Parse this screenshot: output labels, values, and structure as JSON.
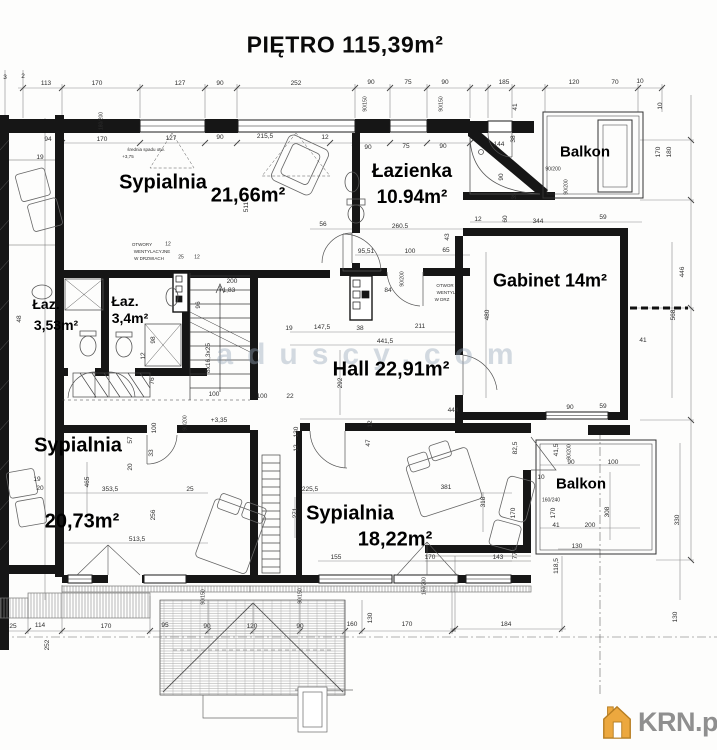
{
  "title": "PIĘTRO 115,39m²",
  "watermark": "aduscy.com",
  "logo": {
    "text": "KRN.pl",
    "house_fill": "#ECA83F",
    "house_stroke": "#B77E22",
    "text_color": "#8f8f8f"
  },
  "rooms": [
    {
      "name": "Sypialnia",
      "area": "21,66m²"
    },
    {
      "name": "Łazienka",
      "area": "10.94m²"
    },
    {
      "name": "Balkon",
      "area": ""
    },
    {
      "name": "Gabinet",
      "area": "14m²"
    },
    {
      "name": "Łaz.",
      "area": "3,53m²"
    },
    {
      "name": "Łaz.",
      "area": "3,4m²"
    },
    {
      "name": "Hall",
      "area": "22,91m²"
    },
    {
      "name": "Sypialnia",
      "area": "20,73m²"
    },
    {
      "name": "Sypialnia",
      "area": "18,22m²"
    },
    {
      "name": "Balkon",
      "area": ""
    }
  ],
  "room_labels": [
    {
      "t": "Sypialnia",
      "x": 163,
      "y": 183,
      "s": 20
    },
    {
      "t": "21,66m²",
      "x": 248,
      "y": 196,
      "s": 20
    },
    {
      "t": "Łazienka",
      "x": 412,
      "y": 172,
      "s": 19
    },
    {
      "t": "10.94m²",
      "x": 412,
      "y": 198,
      "s": 19
    },
    {
      "t": "Balkon",
      "x": 585,
      "y": 152,
      "s": 15
    },
    {
      "t": "Gabinet 14m²",
      "x": 550,
      "y": 281,
      "s": 18
    },
    {
      "t": "Łaz.",
      "x": 46,
      "y": 304,
      "s": 14
    },
    {
      "t": "3,53m²",
      "x": 56,
      "y": 325,
      "s": 14
    },
    {
      "t": "Łaz.",
      "x": 125,
      "y": 301,
      "s": 14
    },
    {
      "t": "3,4m²",
      "x": 130,
      "y": 318,
      "s": 14
    },
    {
      "t": "Hall 22,91m²",
      "x": 391,
      "y": 370,
      "s": 20
    },
    {
      "t": "Sypialnia",
      "x": 78,
      "y": 446,
      "s": 20
    },
    {
      "t": "20,73m²",
      "x": 82,
      "y": 522,
      "s": 20
    },
    {
      "t": "Sypialnia",
      "x": 350,
      "y": 514,
      "s": 20
    },
    {
      "t": "18,22m²",
      "x": 395,
      "y": 540,
      "s": 20
    },
    {
      "t": "Balkon",
      "x": 581,
      "y": 484,
      "s": 15
    }
  ],
  "dims": [
    {
      "t": "3",
      "x": 5,
      "y": 78
    },
    {
      "t": "2",
      "x": 23,
      "y": 77
    },
    {
      "t": "113",
      "x": 46,
      "y": 84
    },
    {
      "t": "170",
      "x": 97,
      "y": 84
    },
    {
      "t": "127",
      "x": 180,
      "y": 84
    },
    {
      "t": "90",
      "x": 220,
      "y": 84
    },
    {
      "t": "252",
      "x": 296,
      "y": 84
    },
    {
      "t": "90",
      "x": 371,
      "y": 83
    },
    {
      "t": "75",
      "x": 408,
      "y": 83
    },
    {
      "t": "90",
      "x": 445,
      "y": 83
    },
    {
      "t": "185",
      "x": 504,
      "y": 83
    },
    {
      "t": "120",
      "x": 574,
      "y": 83
    },
    {
      "t": "70",
      "x": 615,
      "y": 83
    },
    {
      "t": "10",
      "x": 640,
      "y": 82
    },
    {
      "t": "180/200",
      "x": 102,
      "y": 121,
      "r": 1,
      "s": 5
    },
    {
      "t": "90/150",
      "x": 366,
      "y": 104,
      "r": 1,
      "s": 5
    },
    {
      "t": "90/150",
      "x": 442,
      "y": 104,
      "r": 1,
      "s": 5
    },
    {
      "t": "41",
      "x": 516,
      "y": 107,
      "r": 1
    },
    {
      "t": "10",
      "x": 661,
      "y": 106,
      "r": 1
    },
    {
      "t": "94",
      "x": 48,
      "y": 140
    },
    {
      "t": "170",
      "x": 102,
      "y": 140
    },
    {
      "t": "127",
      "x": 171,
      "y": 139
    },
    {
      "t": "90",
      "x": 220,
      "y": 138
    },
    {
      "t": "215,5",
      "x": 265,
      "y": 137
    },
    {
      "t": "12",
      "x": 325,
      "y": 138
    },
    {
      "t": "90",
      "x": 368,
      "y": 148
    },
    {
      "t": "75",
      "x": 406,
      "y": 147
    },
    {
      "t": "90",
      "x": 443,
      "y": 147
    },
    {
      "t": "średnia spadu otw.",
      "x": 146,
      "y": 150,
      "s": 4.5
    },
    {
      "t": "+3,75",
      "x": 128,
      "y": 157,
      "s": 4.5
    },
    {
      "t": "19",
      "x": 40,
      "y": 158
    },
    {
      "t": "144",
      "x": 499,
      "y": 145
    },
    {
      "t": "38",
      "x": 514,
      "y": 139,
      "r": 1
    },
    {
      "t": "90",
      "x": 502,
      "y": 177,
      "r": 1
    },
    {
      "t": "35",
      "x": 515,
      "y": 196,
      "r": 1
    },
    {
      "t": "90/200",
      "x": 553,
      "y": 170,
      "s": 5
    },
    {
      "t": "90/200",
      "x": 567,
      "y": 187,
      "r": 1,
      "s": 5
    },
    {
      "t": "170",
      "x": 659,
      "y": 152,
      "r": 1
    },
    {
      "t": "180",
      "x": 670,
      "y": 152,
      "r": 1
    },
    {
      "t": "12",
      "x": 478,
      "y": 220
    },
    {
      "t": "60",
      "x": 506,
      "y": 219,
      "r": 1
    },
    {
      "t": "344",
      "x": 538,
      "y": 222
    },
    {
      "t": "59",
      "x": 603,
      "y": 218
    },
    {
      "t": "511",
      "x": 247,
      "y": 207,
      "r": 1
    },
    {
      "t": "56",
      "x": 323,
      "y": 225
    },
    {
      "t": "260.5",
      "x": 400,
      "y": 227
    },
    {
      "t": "95,51",
      "x": 366,
      "y": 252
    },
    {
      "t": "100",
      "x": 410,
      "y": 252
    },
    {
      "t": "65",
      "x": 446,
      "y": 251
    },
    {
      "t": "43",
      "x": 448,
      "y": 237,
      "r": 1
    },
    {
      "t": "84",
      "x": 388,
      "y": 291
    },
    {
      "t": "90/200",
      "x": 403,
      "y": 279,
      "r": 1,
      "s": 5
    },
    {
      "t": "OTWOR",
      "x": 445,
      "y": 286,
      "s": 4.5
    },
    {
      "t": "WENTYL",
      "x": 446,
      "y": 293,
      "s": 4.5
    },
    {
      "t": "W DRZ",
      "x": 442,
      "y": 300,
      "s": 4.5
    },
    {
      "t": "OTWORY",
      "x": 142,
      "y": 245,
      "s": 4.5
    },
    {
      "t": "WENTYLACYJNE",
      "x": 152,
      "y": 252,
      "s": 4.5
    },
    {
      "t": "W DRZWIACH",
      "x": 149,
      "y": 259,
      "s": 4.5
    },
    {
      "t": "12",
      "x": 168,
      "y": 245,
      "s": 5
    },
    {
      "t": "25",
      "x": 181,
      "y": 258,
      "s": 5
    },
    {
      "t": "12",
      "x": 197,
      "y": 258,
      "s": 5
    },
    {
      "t": "200",
      "x": 232,
      "y": 282
    },
    {
      "t": "+1,83",
      "x": 227,
      "y": 291
    },
    {
      "t": "96",
      "x": 199,
      "y": 305,
      "r": 1
    },
    {
      "t": "8x16,3x25",
      "x": 209,
      "y": 358,
      "r": 1
    },
    {
      "t": "98",
      "x": 154,
      "y": 340,
      "r": 1
    },
    {
      "t": "12",
      "x": 144,
      "y": 356,
      "r": 1
    },
    {
      "t": "76",
      "x": 153,
      "y": 381,
      "r": 1
    },
    {
      "t": "100",
      "x": 214,
      "y": 395
    },
    {
      "t": "90/200",
      "x": 186,
      "y": 423,
      "r": 1,
      "s": 5
    },
    {
      "t": "+3,35",
      "x": 219,
      "y": 421
    },
    {
      "t": "48",
      "x": 20,
      "y": 319,
      "r": 1
    },
    {
      "t": "19",
      "x": 289,
      "y": 329
    },
    {
      "t": "147,5",
      "x": 322,
      "y": 328
    },
    {
      "t": "38",
      "x": 360,
      "y": 329
    },
    {
      "t": "211",
      "x": 420,
      "y": 327
    },
    {
      "t": "441,5",
      "x": 385,
      "y": 342
    },
    {
      "t": "292",
      "x": 341,
      "y": 383,
      "r": 1
    },
    {
      "t": "444",
      "x": 453,
      "y": 411
    },
    {
      "t": "12",
      "x": 371,
      "y": 424,
      "r": 1
    },
    {
      "t": "47",
      "x": 369,
      "y": 443,
      "r": 1
    },
    {
      "t": "100",
      "x": 262,
      "y": 397
    },
    {
      "t": "22",
      "x": 290,
      "y": 397
    },
    {
      "t": "130",
      "x": 297,
      "y": 432,
      "r": 1
    },
    {
      "t": "12",
      "x": 297,
      "y": 448,
      "r": 1
    },
    {
      "t": "480",
      "x": 488,
      "y": 315,
      "r": 1
    },
    {
      "t": "568",
      "x": 674,
      "y": 315,
      "r": 1
    },
    {
      "t": "446",
      "x": 683,
      "y": 272,
      "r": 1
    },
    {
      "t": "41",
      "x": 643,
      "y": 341
    },
    {
      "t": "90",
      "x": 570,
      "y": 408
    },
    {
      "t": "59",
      "x": 603,
      "y": 407
    },
    {
      "t": "41,5",
      "x": 557,
      "y": 450,
      "r": 1
    },
    {
      "t": "90/200",
      "x": 570,
      "y": 452,
      "r": 1,
      "s": 5
    },
    {
      "t": "90",
      "x": 571,
      "y": 463
    },
    {
      "t": "100",
      "x": 613,
      "y": 463
    },
    {
      "t": "10",
      "x": 541,
      "y": 478
    },
    {
      "t": "160/240",
      "x": 551,
      "y": 501,
      "s": 5
    },
    {
      "t": "170",
      "x": 554,
      "y": 513,
      "r": 1
    },
    {
      "t": "41",
      "x": 556,
      "y": 526
    },
    {
      "t": "200",
      "x": 590,
      "y": 526
    },
    {
      "t": "130",
      "x": 577,
      "y": 547
    },
    {
      "t": "308",
      "x": 608,
      "y": 512,
      "r": 1
    },
    {
      "t": "330",
      "x": 678,
      "y": 520,
      "r": 1
    },
    {
      "t": "118,5",
      "x": 557,
      "y": 566,
      "r": 1
    },
    {
      "t": "57",
      "x": 131,
      "y": 440,
      "r": 1
    },
    {
      "t": "100",
      "x": 155,
      "y": 428,
      "r": 1
    },
    {
      "t": "33",
      "x": 152,
      "y": 453,
      "r": 1
    },
    {
      "t": "20",
      "x": 131,
      "y": 467,
      "r": 1
    },
    {
      "t": "25",
      "x": 190,
      "y": 490
    },
    {
      "t": "19",
      "x": 37,
      "y": 480
    },
    {
      "t": "20",
      "x": 40,
      "y": 489
    },
    {
      "t": "465",
      "x": 88,
      "y": 482,
      "r": 1
    },
    {
      "t": "353,5",
      "x": 110,
      "y": 490
    },
    {
      "t": "256",
      "x": 154,
      "y": 515,
      "r": 1
    },
    {
      "t": "513,5",
      "x": 137,
      "y": 540
    },
    {
      "t": "225,5",
      "x": 310,
      "y": 490
    },
    {
      "t": "271",
      "x": 296,
      "y": 513,
      "r": 1
    },
    {
      "t": "381",
      "x": 446,
      "y": 488
    },
    {
      "t": "318",
      "x": 484,
      "y": 502,
      "r": 1
    },
    {
      "t": "82,5",
      "x": 516,
      "y": 448,
      "r": 1
    },
    {
      "t": "170",
      "x": 514,
      "y": 513,
      "r": 1
    },
    {
      "t": "77,5",
      "x": 516,
      "y": 553,
      "r": 1
    },
    {
      "t": "155",
      "x": 336,
      "y": 558
    },
    {
      "t": "170",
      "x": 430,
      "y": 558
    },
    {
      "t": "143",
      "x": 498,
      "y": 558
    },
    {
      "t": "160/200",
      "x": 425,
      "y": 586,
      "r": 1,
      "s": 5
    },
    {
      "t": "90/150",
      "x": 204,
      "y": 597,
      "r": 1,
      "s": 5
    },
    {
      "t": "90/150",
      "x": 301,
      "y": 596,
      "r": 1,
      "s": 5
    },
    {
      "t": "25",
      "x": 13,
      "y": 627
    },
    {
      "t": "114",
      "x": 40,
      "y": 626
    },
    {
      "t": "170",
      "x": 106,
      "y": 627
    },
    {
      "t": "95",
      "x": 165,
      "y": 626
    },
    {
      "t": "90",
      "x": 207,
      "y": 627
    },
    {
      "t": "120",
      "x": 252,
      "y": 627
    },
    {
      "t": "90",
      "x": 300,
      "y": 627
    },
    {
      "t": "160",
      "x": 352,
      "y": 625
    },
    {
      "t": "130",
      "x": 371,
      "y": 618,
      "r": 1
    },
    {
      "t": "170",
      "x": 407,
      "y": 625
    },
    {
      "t": "252",
      "x": 48,
      "y": 645,
      "r": 1
    },
    {
      "t": "184",
      "x": 506,
      "y": 625
    },
    {
      "t": "130",
      "x": 676,
      "y": 617,
      "r": 1
    }
  ]
}
